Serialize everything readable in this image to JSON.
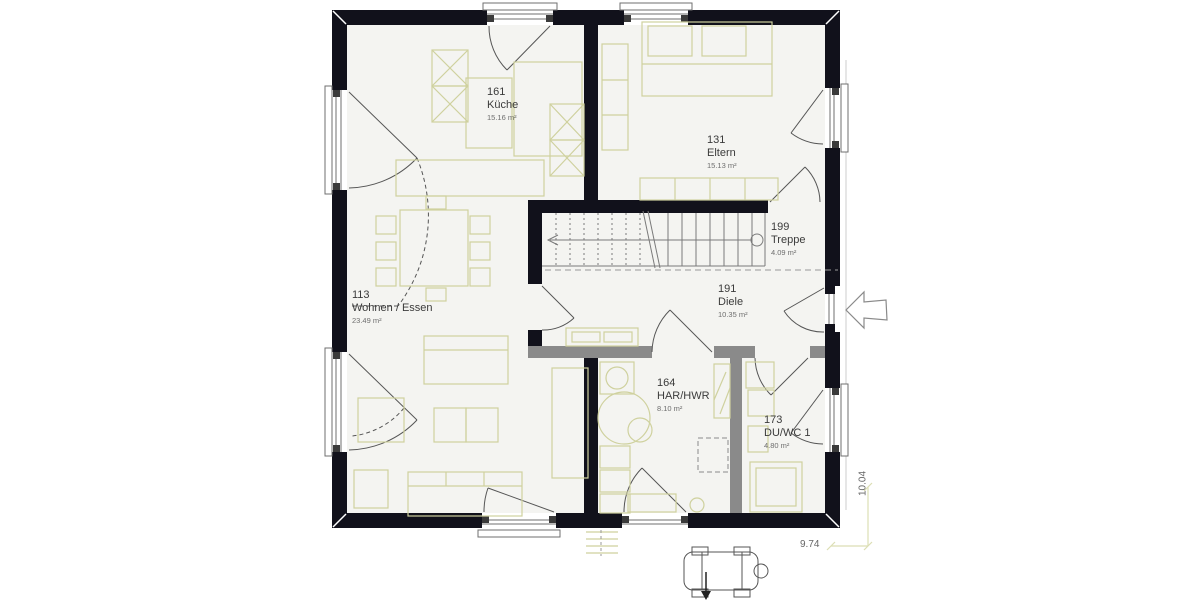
{
  "rooms": {
    "kueche": {
      "number": "161",
      "name": "Küche",
      "area": "15.16 m²"
    },
    "eltern": {
      "number": "131",
      "name": "Eltern",
      "area": "15.13 m²"
    },
    "treppe": {
      "number": "199",
      "name": "Treppe",
      "area": "4.09 m²"
    },
    "diele": {
      "number": "191",
      "name": "Diele",
      "area": "10.35 m²"
    },
    "wohnen": {
      "number": "113",
      "name": "Wohnen / Essen",
      "area": "23.49 m²"
    },
    "har": {
      "number": "164",
      "name": "HAR/HWR",
      "area": "8.10 m²"
    },
    "duwc": {
      "number": "173",
      "name": "DU/WC 1",
      "area": "4.80 m²"
    }
  },
  "dimensions": {
    "height": "10.04",
    "width": "9.74"
  },
  "colors": {
    "wall": "#11111b",
    "interior_wall": "#8a8a8a",
    "floor": "#f4f4f1",
    "furniture": "#cfd19e",
    "dimension": "#dcdeb4"
  }
}
